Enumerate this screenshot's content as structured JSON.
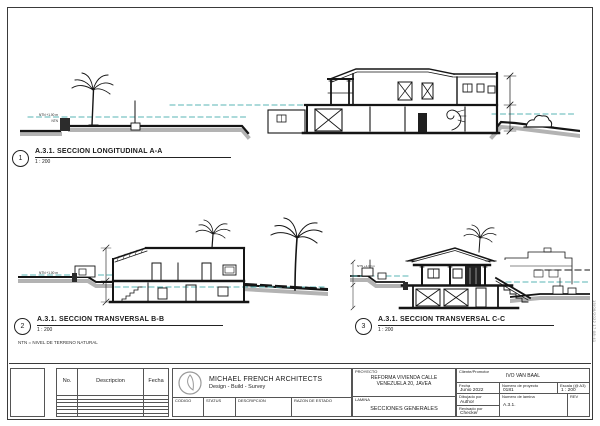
{
  "sections": [
    {
      "number": "1",
      "title": "A.3.1. SECCION LONGITUDINAL A-A",
      "scale": "1 : 200"
    },
    {
      "number": "2",
      "title": "A.3.1. SECCION TRANSVERSAL B-B",
      "scale": "1 : 200"
    },
    {
      "number": "3",
      "title": "A.3.1. SECCION TRANSVERSAL C-C",
      "scale": "1 : 200"
    }
  ],
  "note": "NTN = NIVEL DE TERRENO NATURAL",
  "drawing_labels": {
    "ntn_level": "NTN +1.00 m",
    "ntn": "NTN"
  },
  "titleblock": {
    "revision_table": {
      "headers": [
        "No.",
        "Descripcion",
        "Fecha"
      ],
      "empty_rows": 7
    },
    "firm": {
      "name": "MICHAEL FRENCH ARCHITECTS",
      "tagline": "Design - Build - Survey"
    },
    "status_row": {
      "codigo": "CODIGO",
      "status": "STATUS",
      "descripcion": "DESCRIPCION",
      "razon": "RAZON DE ESTADO"
    },
    "project": {
      "label": "PROYECTO",
      "value": "REFORMA VIVIENDA CALLE VENEZUELA 20, JAVEA"
    },
    "lamina": {
      "label": "LAMINA",
      "value": "SECCIONES GENERALES"
    },
    "client": {
      "label": "Cliente/Promotor",
      "value": "IVO VAN BAAL"
    },
    "fecha": {
      "label": "Fecha",
      "value": "Junio 2022"
    },
    "project_number": {
      "label": "Numero de proyecto",
      "value": "0181"
    },
    "escala": {
      "label": "Escala (@ A3)",
      "value": "1 : 200"
    },
    "dibujado": {
      "label": "Dibujado por",
      "value": "Author"
    },
    "revisado": {
      "label": "Revisado por",
      "value": "Checker"
    },
    "sheet_number": {
      "label": "Numero de lamina",
      "value": "A.3.1."
    },
    "rev": "REV",
    "stamp": "15/06/2022 17:08:41"
  }
}
